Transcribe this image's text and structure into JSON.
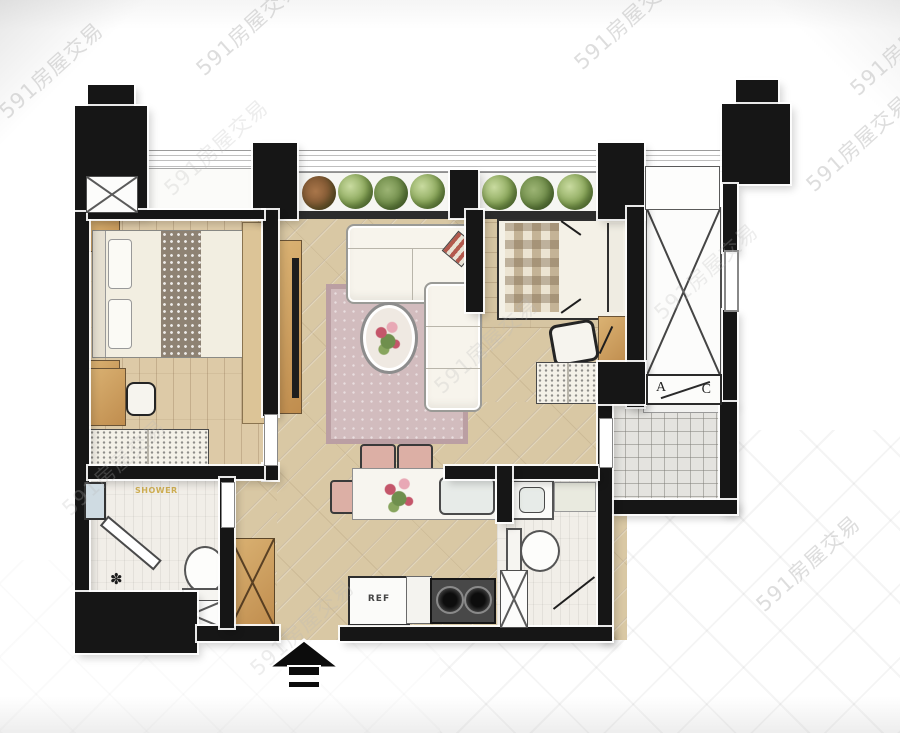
{
  "watermark": {
    "text": "591房屋交易"
  },
  "labels": {
    "ac_left": "A",
    "ac_right": "C",
    "fridge": "REF",
    "shower": "SHOWER",
    "drain_icon": "✽"
  },
  "colors": {
    "wall": "#161616",
    "living_floor": "#d9c8a4",
    "bedroom_floor": "#ddcaa7",
    "tile_floor": "#e4e3df",
    "bath_floor": "#f1eee8",
    "rug": "#d2bcbe",
    "plant_green": "#88a558",
    "furniture_wood": "#c08d4e",
    "watermark_gray": "#afafaf"
  }
}
